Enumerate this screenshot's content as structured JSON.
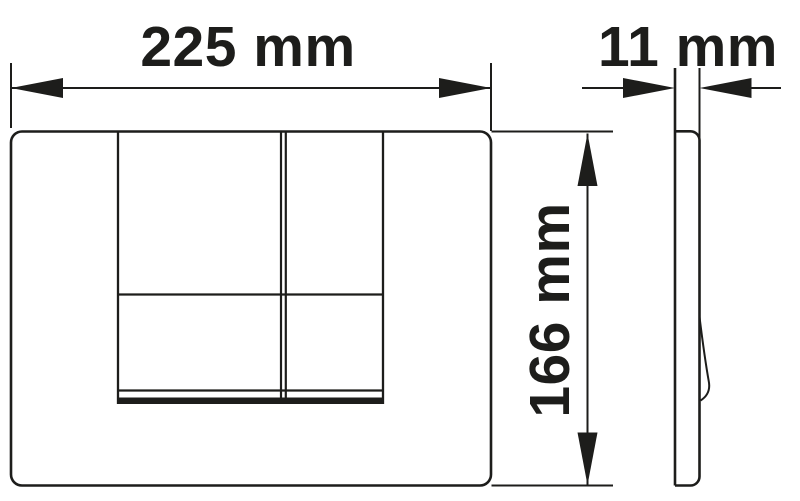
{
  "drawing": {
    "labels": {
      "width": "225 mm",
      "depth": "11 mm",
      "height": "166 mm"
    },
    "colors": {
      "line": "#1d1d1b",
      "background": "#ffffff"
    }
  }
}
